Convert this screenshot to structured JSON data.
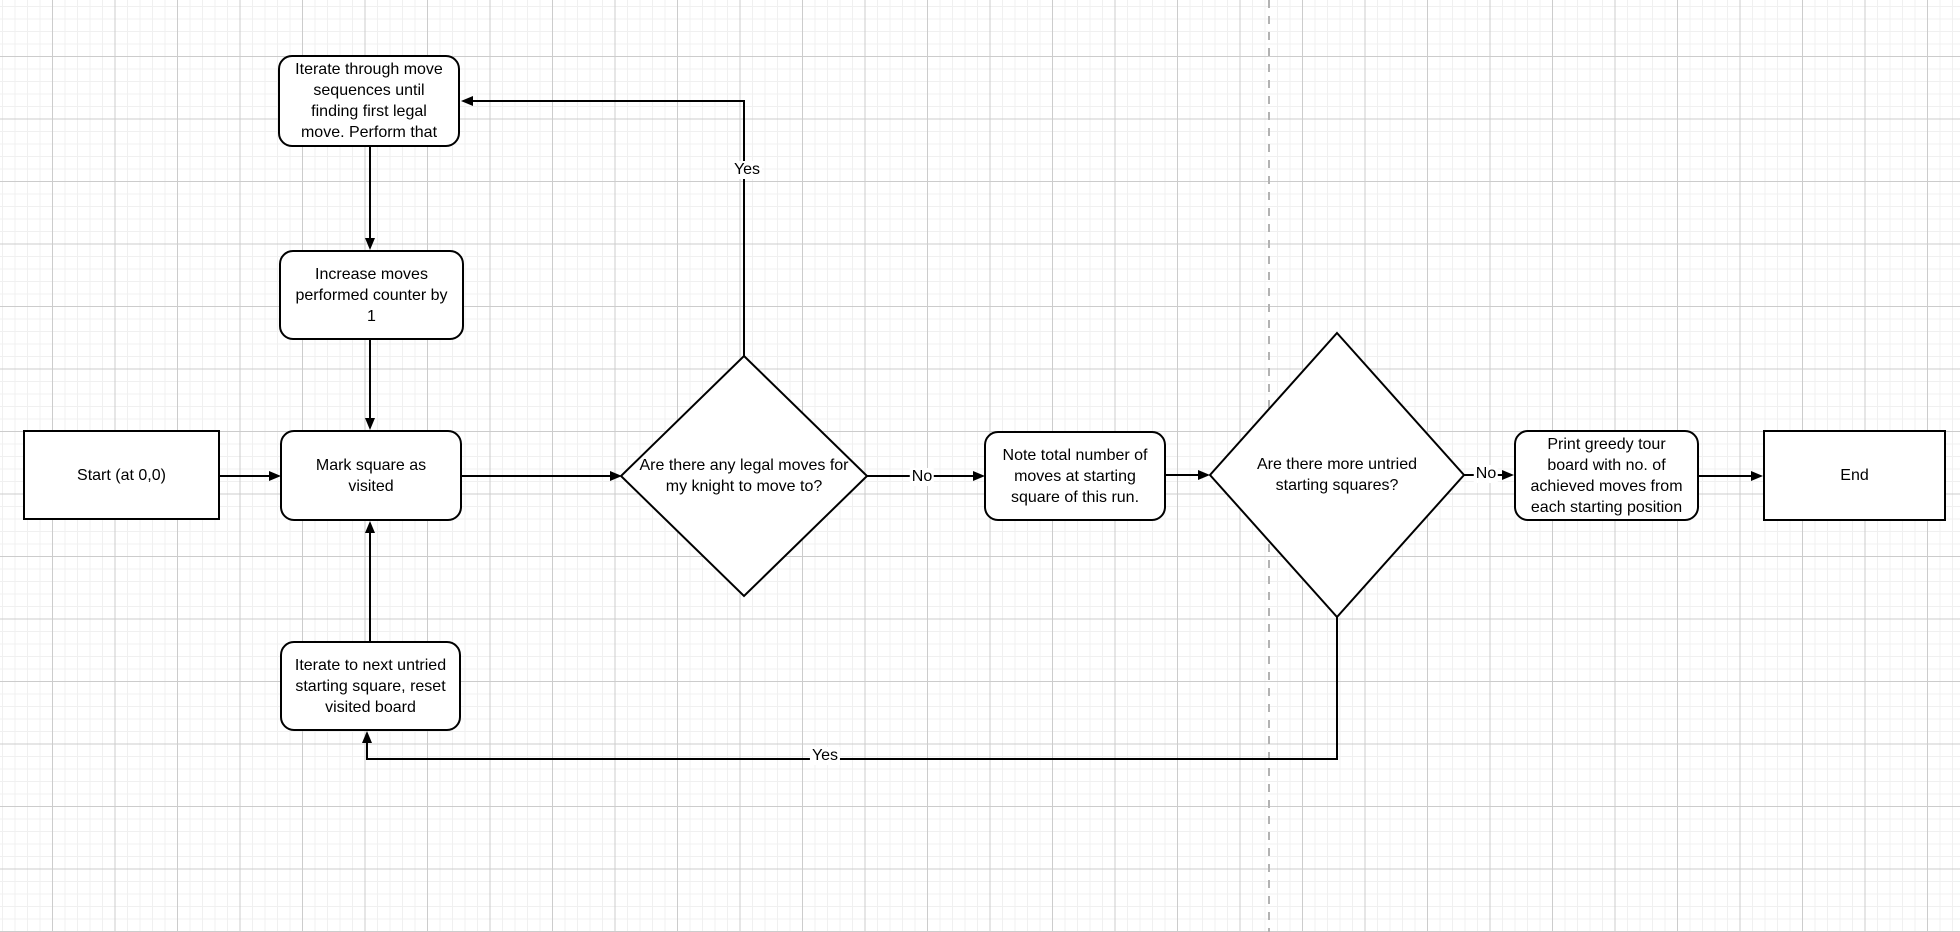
{
  "canvas": {
    "background": "#ffffff",
    "grid_minor_color": "#f0f0f0",
    "grid_major_color": "#cccccc",
    "page_divider_color": "#b3b3b3",
    "node_fill": "#ffffff",
    "node_stroke": "#000000",
    "edge_color": "#000000"
  },
  "nodes": [
    {
      "id": "start",
      "shape": "rectangle",
      "label": "Start (at 0,0)"
    },
    {
      "id": "iterate-move-sequences",
      "shape": "rounded",
      "label": "Iterate through move\nsequences until\nfinding first legal\nmove. Perform that"
    },
    {
      "id": "increase-counter",
      "shape": "rounded",
      "label": "Increase moves\nperformed counter by\n1"
    },
    {
      "id": "mark-square-visited",
      "shape": "rounded",
      "label": "Mark square as\nvisited"
    },
    {
      "id": "legal-moves-decision",
      "shape": "diamond",
      "label": "Are there any legal moves for\nmy knight to move to?"
    },
    {
      "id": "note-total-moves",
      "shape": "rounded",
      "label": "Note total number of\nmoves at starting\nsquare of this run."
    },
    {
      "id": "untried-squares-decision",
      "shape": "diamond",
      "label": "Are there more untried\nstarting squares?"
    },
    {
      "id": "print-board",
      "shape": "rounded",
      "label": "Print greedy tour\nboard with no. of\nachieved moves from\neach starting position"
    },
    {
      "id": "end",
      "shape": "rectangle",
      "label": "End"
    },
    {
      "id": "iterate-next-square",
      "shape": "rounded",
      "label": "Iterate to next untried\nstarting square, reset\nvisited board"
    }
  ],
  "edges": [
    {
      "from": "start",
      "to": "mark-square-visited",
      "label": ""
    },
    {
      "from": "iterate-move-sequences",
      "to": "increase-counter",
      "label": ""
    },
    {
      "from": "increase-counter",
      "to": "mark-square-visited",
      "label": ""
    },
    {
      "from": "mark-square-visited",
      "to": "legal-moves-decision",
      "label": ""
    },
    {
      "from": "legal-moves-decision",
      "to": "iterate-move-sequences",
      "label": "Yes"
    },
    {
      "from": "legal-moves-decision",
      "to": "note-total-moves",
      "label": "No"
    },
    {
      "from": "note-total-moves",
      "to": "untried-squares-decision",
      "label": ""
    },
    {
      "from": "untried-squares-decision",
      "to": "print-board",
      "label": "No"
    },
    {
      "from": "untried-squares-decision",
      "to": "iterate-next-square",
      "label": "Yes"
    },
    {
      "from": "print-board",
      "to": "end",
      "label": ""
    },
    {
      "from": "iterate-next-square",
      "to": "mark-square-visited",
      "label": ""
    }
  ]
}
